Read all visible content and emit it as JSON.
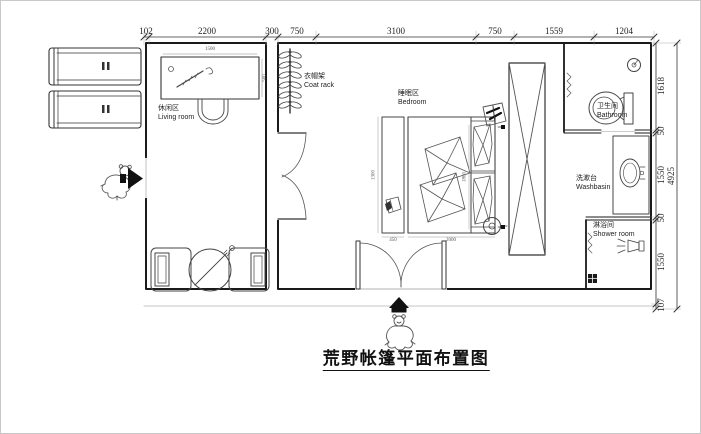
{
  "title": "荒野帐篷平面布置图",
  "rooms": {
    "living": {
      "zh": "休闲区",
      "en": "Living room"
    },
    "coat_rack": {
      "zh": "衣帽架",
      "en": "Coat rack"
    },
    "bedroom": {
      "zh": "睡眠区",
      "en": "Bedroom"
    },
    "bathroom": {
      "zh": "卫生间",
      "en": "Bathroom"
    },
    "washbasin": {
      "zh": "洗漱台",
      "en": "Washbasin"
    },
    "shower": {
      "zh": "淋浴间",
      "en": "Shower room"
    }
  },
  "dims_top": [
    "102",
    "2200",
    "300",
    "750",
    "3100",
    "750",
    "1559",
    "1204"
  ],
  "dims_right": [
    "1618",
    "50",
    "1550",
    "50",
    "1550",
    "107"
  ],
  "dims_right_total": "4925",
  "dims_interior": {
    "desk_width": "1500",
    "desk_depth": "500",
    "bench_length": "1300",
    "bench_width": "450",
    "bed_length": "2000",
    "bed_width": "1800"
  },
  "icons": {
    "entrance-arrow-right": "▶",
    "entrance-arrow-up": "▲",
    "toilet": "toilet-plan-symbol",
    "toilet-paper": "roll-circle-symbol",
    "washbasin": "oval-basin-symbol",
    "shower-head": "sprayer-symbol",
    "floor-drain": "drain-square-symbol",
    "coat-rack": "hanger-rail-symbol",
    "towel-rack": "zigzag-symbol",
    "bear-sketch": "hand-drawn-bear"
  },
  "colors": {
    "background": "#ffffff",
    "wall": "#1a1a1a",
    "line": "#444444",
    "sketch": "#555555",
    "dim_text": "#222222",
    "light_line": "#999999"
  }
}
